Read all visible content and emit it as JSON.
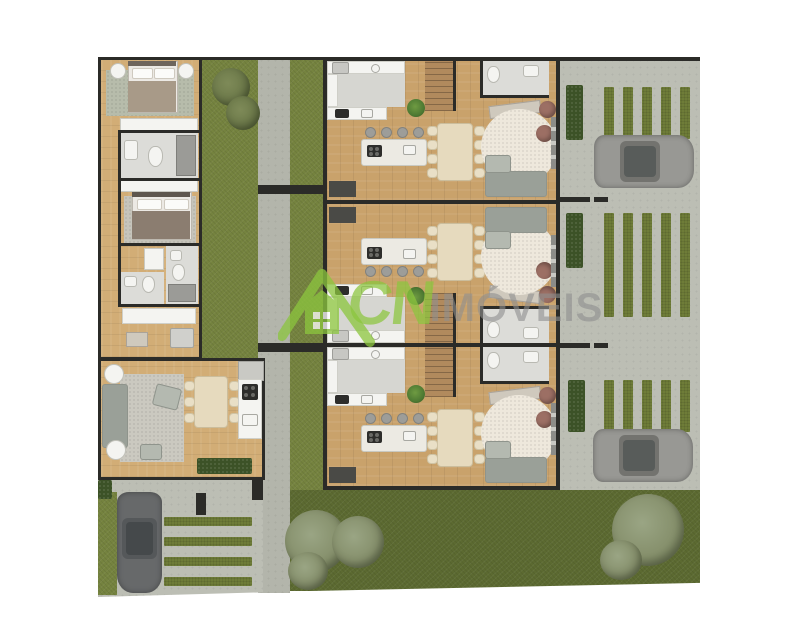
{
  "watermark": {
    "logo_letters": "CN",
    "brand_text": "IMÓVEIS"
  },
  "scene": {
    "middle_units_count": 3,
    "cars_count": 3,
    "parking_grass_strips_per_bay": 5,
    "left_house_rooms": [
      "bedroom",
      "wardrobe",
      "bathroom",
      "bedroom",
      "bathroom",
      "bathroom",
      "laundry",
      "living-room",
      "dining-room",
      "kitchen"
    ],
    "middle_unit_rooms": [
      "laundry",
      "stairs",
      "bathroom",
      "kitchen",
      "dining-room",
      "living-room"
    ]
  },
  "palette": {
    "wall": "#2b2b28",
    "wood": "#c9a26b",
    "wood_light": "#d2ad76",
    "stair_wood": "#b18a5d",
    "grass": "#75833f",
    "grass_strip": "#6e7c38",
    "lawn": "#5c6a31",
    "hedge": "#3c5227",
    "concrete": "#bcbeb4",
    "concrete_path": "#b3b5ab",
    "tile": "#dcdcd8",
    "laundry_floor": "#d6d6d1",
    "white": "#f4f4f1",
    "marble": "#eceae3",
    "stool": "#9d9d99",
    "chair": "#e9dfc6",
    "table": "#e6dabe",
    "rug_round": "#eee8dc",
    "rug_living": "#cbc9c0",
    "rug_bedroom": "#b7bcab",
    "sofa": "#b4b9b0",
    "sofa_dark": "#9aa098",
    "pouf": "#9c6f64",
    "bed_blanket": "#a89a88",
    "bed_blanket2": "#8b7d70",
    "car_light": "#989894",
    "car_dark": "#67696a",
    "car_glass": "#585c5a",
    "tree": "#86906c",
    "tree_dark": "#6d7a4a",
    "plant": "#4e7a33",
    "watermark_green": "#8cc63e",
    "watermark_gray": "#8f8f8f"
  }
}
